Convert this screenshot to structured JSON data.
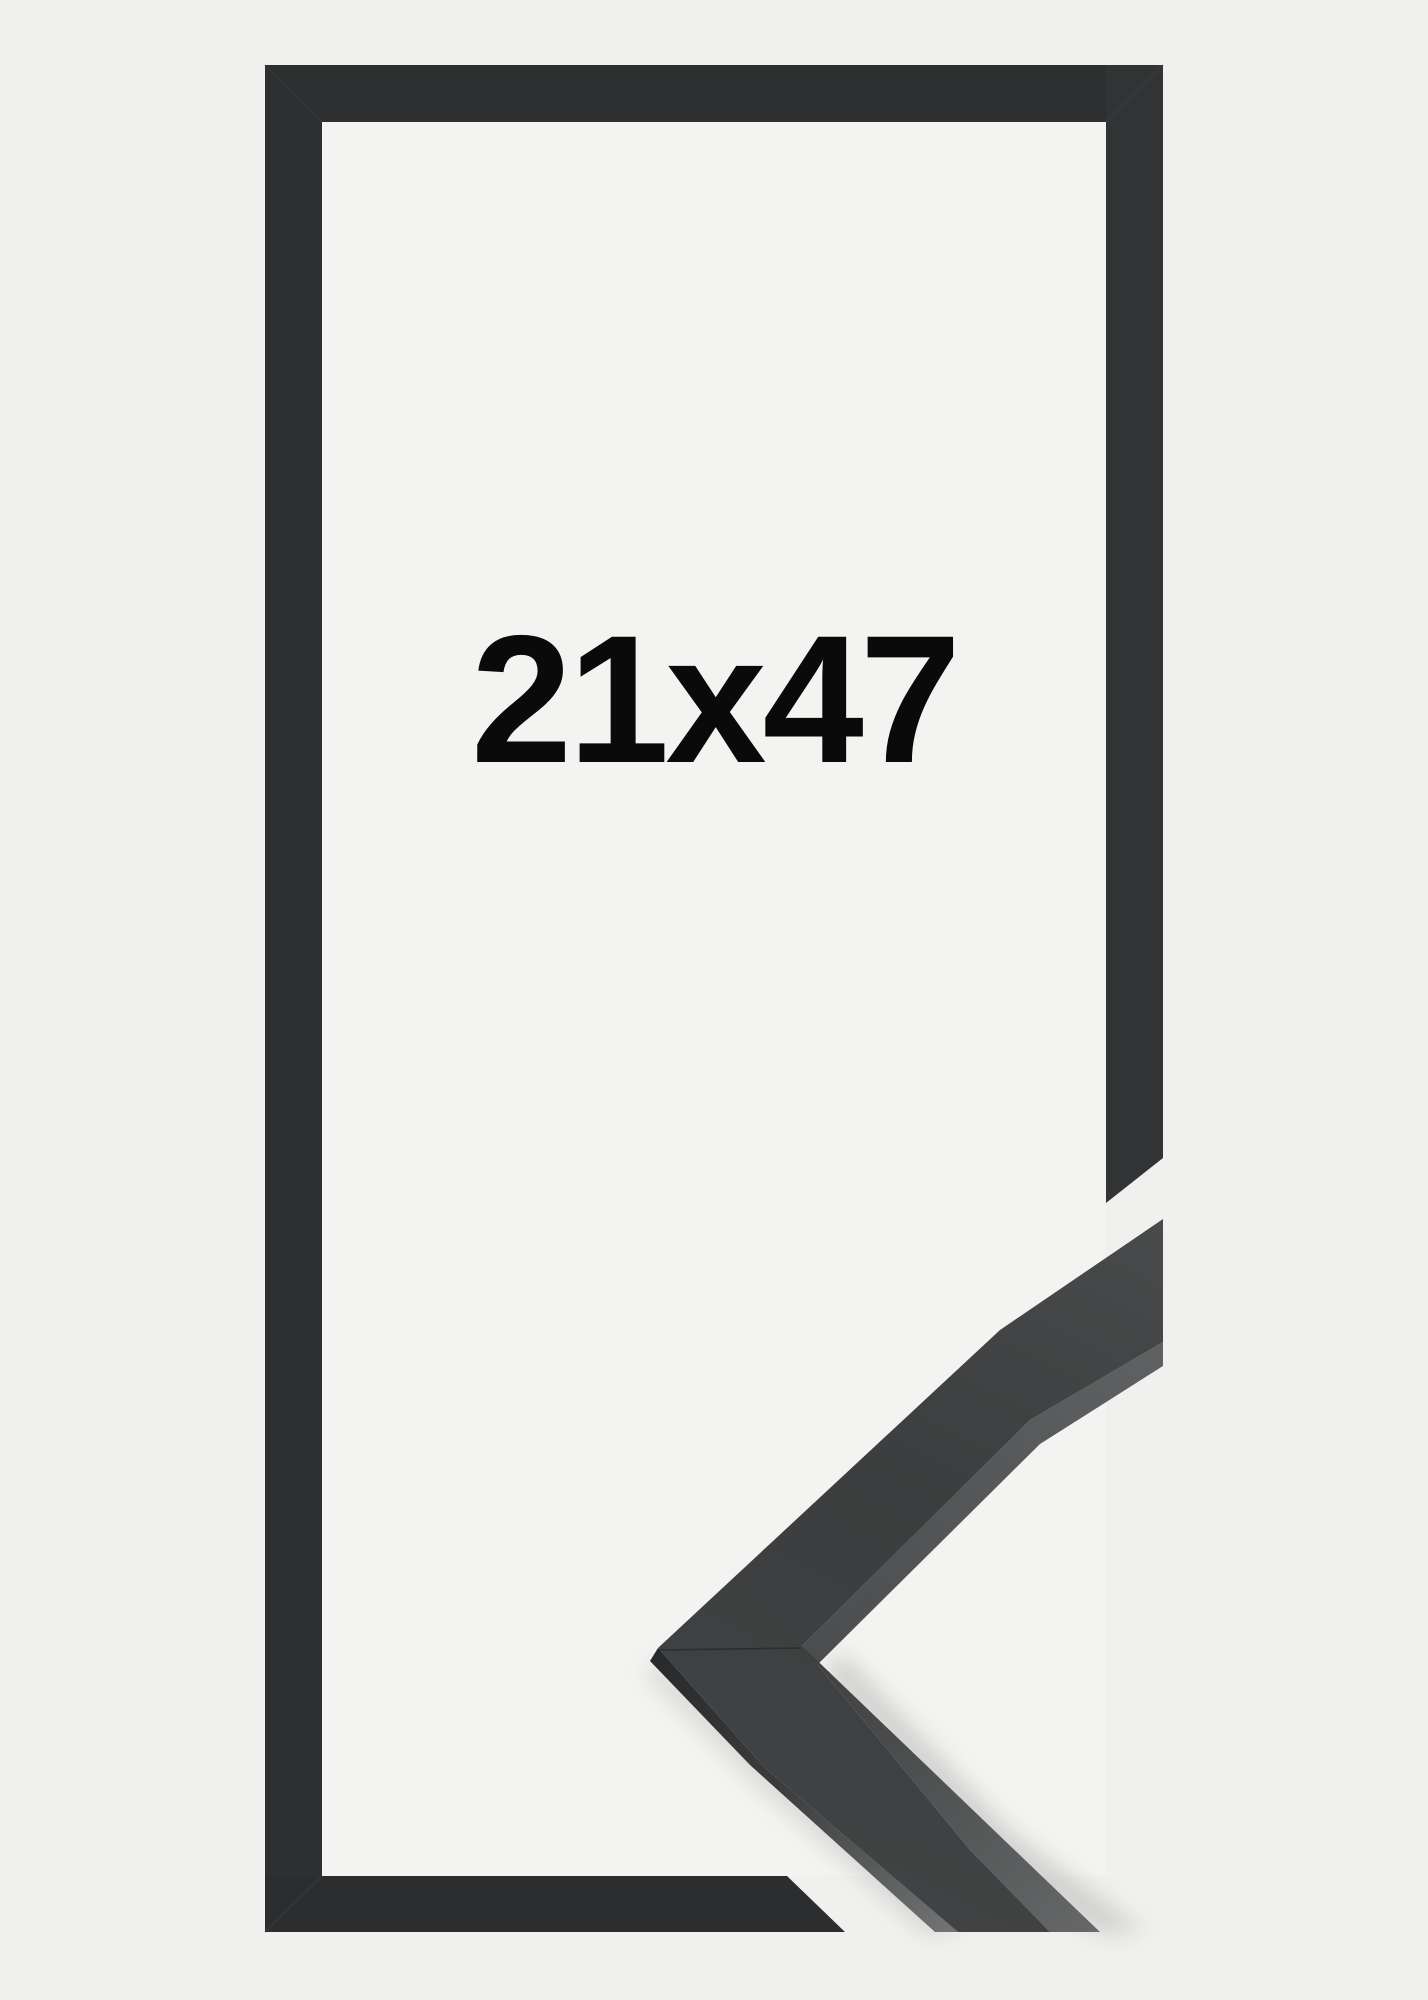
{
  "product": {
    "size_label": "21x47"
  },
  "colors": {
    "background": "#f0f0ee",
    "frame_interior": "#f3f3f1",
    "frame_bar": "#2e2f30",
    "frame_bar_right": "#323334",
    "frame_bar_bottom": "#2c2d2e",
    "miter_seam": "#3d3e3f",
    "size_text": "#0a0a0a",
    "moulding_face_top": "#484a4b",
    "moulding_face_mid": "#3b3d3e",
    "moulding_face_bottom": "#414344",
    "moulding_side_dark": "#28292b",
    "moulding_side_mid": "#3a3c3d",
    "moulding_side_light": "#6f7172",
    "moulding_edge_top": "#4b4d4f",
    "moulding_edge_bottom": "#5e6062",
    "moulding_edge2_top": "#3c3e3f",
    "moulding_edge2_bottom": "#656768",
    "moulding_seam": "#232425",
    "shadow": "#a8a8a6"
  }
}
